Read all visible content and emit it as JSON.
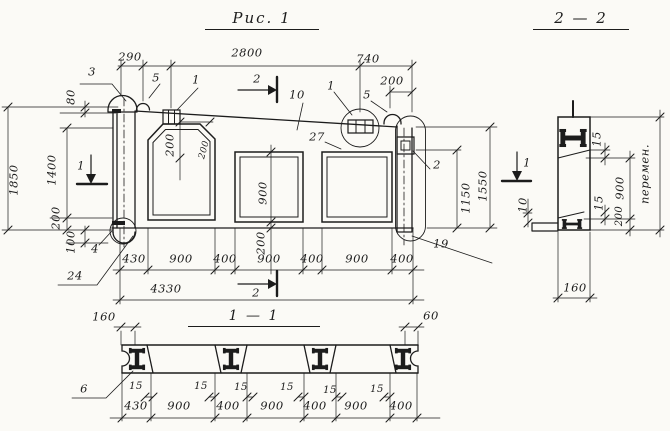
{
  "colors": {
    "ink": "#1c1c1c",
    "paper": "#fbfaf6"
  },
  "titles": {
    "figure": "Рис. 1",
    "section_2_2": "2 — 2",
    "section_1_1": "1 — 1"
  },
  "views": {
    "elevation": {
      "labels": [
        {
          "name": "dim-290",
          "text": "290",
          "x": 130,
          "y": 57
        },
        {
          "name": "dim-2800",
          "text": "2800",
          "x": 247,
          "y": 53
        },
        {
          "name": "dim-740",
          "text": "740",
          "x": 368,
          "y": 59
        },
        {
          "name": "dim-200-top-right",
          "text": "200",
          "x": 392,
          "y": 81
        },
        {
          "name": "dim-1850",
          "text": "1850",
          "x": 14,
          "y": 180,
          "rot": -90
        },
        {
          "name": "dim-80",
          "text": "80",
          "x": 71,
          "y": 97,
          "rot": -90
        },
        {
          "name": "dim-1400",
          "text": "1400",
          "x": 52,
          "y": 170,
          "rot": -90
        },
        {
          "name": "dim-200-left",
          "text": "200",
          "x": 56,
          "y": 218,
          "rot": -90
        },
        {
          "name": "dim-100-left",
          "text": "100",
          "x": 71,
          "y": 242,
          "rot": -90
        },
        {
          "name": "dim-200-opening1-vert",
          "text": "200",
          "x": 170,
          "y": 145,
          "rot": -90
        },
        {
          "name": "dim-200-opening1-horiz",
          "text": "200",
          "x": 205,
          "y": 150,
          "rot": -75,
          "fs": 9
        },
        {
          "name": "dim-900-opening2",
          "text": "900",
          "x": 263,
          "y": 193,
          "rot": -90
        },
        {
          "name": "dim-200-under-opening2",
          "text": "200",
          "x": 261,
          "y": 243,
          "rot": -90
        },
        {
          "name": "dim-1150",
          "text": "1150",
          "x": 466,
          "y": 198,
          "rot": -90
        },
        {
          "name": "dim-1550",
          "text": "1550",
          "x": 483,
          "y": 186,
          "rot": -90
        },
        {
          "name": "dim-430-bottom",
          "text": "430",
          "x": 134,
          "y": 259
        },
        {
          "name": "dim-900-bay1",
          "text": "900",
          "x": 181,
          "y": 259
        },
        {
          "name": "dim-400-a",
          "text": "400",
          "x": 225,
          "y": 259
        },
        {
          "name": "dim-900-bay2",
          "text": "900",
          "x": 269,
          "y": 259
        },
        {
          "name": "dim-400-b",
          "text": "400",
          "x": 312,
          "y": 259
        },
        {
          "name": "dim-900-bay3",
          "text": "900",
          "x": 357,
          "y": 259
        },
        {
          "name": "dim-400-c",
          "text": "400",
          "x": 402,
          "y": 259
        },
        {
          "name": "dim-4330-overall",
          "text": "4330",
          "x": 166,
          "y": 289
        },
        {
          "name": "callout-3",
          "text": "3",
          "x": 92,
          "y": 72
        },
        {
          "name": "callout-5-left",
          "text": "5",
          "x": 156,
          "y": 78
        },
        {
          "name": "callout-1-left",
          "text": "1",
          "x": 196,
          "y": 80
        },
        {
          "name": "callout-10",
          "text": "10",
          "x": 297,
          "y": 95
        },
        {
          "name": "callout-27",
          "text": "27",
          "x": 317,
          "y": 137
        },
        {
          "name": "callout-1-right",
          "text": "1",
          "x": 331,
          "y": 86
        },
        {
          "name": "callout-5-right",
          "text": "5",
          "x": 367,
          "y": 95
        },
        {
          "name": "callout-2",
          "text": "2",
          "x": 437,
          "y": 165
        },
        {
          "name": "callout-19",
          "text": "19",
          "x": 441,
          "y": 244
        },
        {
          "name": "callout-4",
          "text": "4",
          "x": 95,
          "y": 249
        },
        {
          "name": "callout-24",
          "text": "24",
          "x": 75,
          "y": 276
        },
        {
          "name": "section-marker-2-top",
          "text": "2",
          "x": 257,
          "y": 79
        },
        {
          "name": "section-marker-2-bottom",
          "text": "2",
          "x": 256,
          "y": 293
        },
        {
          "name": "section-marker-1-left",
          "text": "1",
          "x": 81,
          "y": 166
        },
        {
          "name": "section-marker-1-right",
          "text": "1",
          "x": 527,
          "y": 163
        }
      ]
    },
    "section_2_2": {
      "labels": [
        {
          "name": "s22-dim-15-upper",
          "text": "15",
          "x": 597,
          "y": 139,
          "rot": -90
        },
        {
          "name": "s22-dim-900",
          "text": "900",
          "x": 620,
          "y": 188,
          "rot": -90
        },
        {
          "name": "s22-dim-15-lower",
          "text": "15",
          "x": 599,
          "y": 203,
          "rot": -90
        },
        {
          "name": "s22-dim-200",
          "text": "200",
          "x": 620,
          "y": 216,
          "rot": -90,
          "fs": 10
        },
        {
          "name": "s22-dim-10",
          "text": "10",
          "x": 523,
          "y": 205,
          "rot": -90
        },
        {
          "name": "s22-dim-variable",
          "text": "перемен.",
          "x": 645,
          "y": 174,
          "rot": -90
        },
        {
          "name": "s22-dim-160",
          "text": "160",
          "x": 575,
          "y": 288
        }
      ]
    },
    "section_1_1": {
      "labels": [
        {
          "name": "s11-dim-160",
          "text": "160",
          "x": 104,
          "y": 317
        },
        {
          "name": "s11-dim-60",
          "text": "60",
          "x": 431,
          "y": 316
        },
        {
          "name": "s11-callout-6",
          "text": "6",
          "x": 84,
          "y": 389
        },
        {
          "name": "s11-dim-15-a",
          "text": "15",
          "x": 136,
          "y": 387,
          "fs": 10
        },
        {
          "name": "s11-dim-15-b",
          "text": "15",
          "x": 201,
          "y": 387,
          "fs": 10
        },
        {
          "name": "s11-dim-15-c",
          "text": "15",
          "x": 241,
          "y": 388,
          "fs": 10
        },
        {
          "name": "s11-dim-15-d",
          "text": "15",
          "x": 287,
          "y": 388,
          "fs": 10
        },
        {
          "name": "s11-dim-15-e",
          "text": "15",
          "x": 330,
          "y": 391,
          "fs": 10
        },
        {
          "name": "s11-dim-15-f",
          "text": "15",
          "x": 377,
          "y": 390,
          "fs": 10
        },
        {
          "name": "s11-dim-430",
          "text": "430",
          "x": 136,
          "y": 406
        },
        {
          "name": "s11-dim-900-bay1",
          "text": "900",
          "x": 179,
          "y": 406
        },
        {
          "name": "s11-dim-400-a",
          "text": "400",
          "x": 228,
          "y": 406
        },
        {
          "name": "s11-dim-900-bay2",
          "text": "900",
          "x": 272,
          "y": 406
        },
        {
          "name": "s11-dim-400-b",
          "text": "400",
          "x": 315,
          "y": 406
        },
        {
          "name": "s11-dim-900-bay3",
          "text": "900",
          "x": 356,
          "y": 406
        },
        {
          "name": "s11-dim-400-c",
          "text": "400",
          "x": 401,
          "y": 406
        }
      ]
    }
  }
}
